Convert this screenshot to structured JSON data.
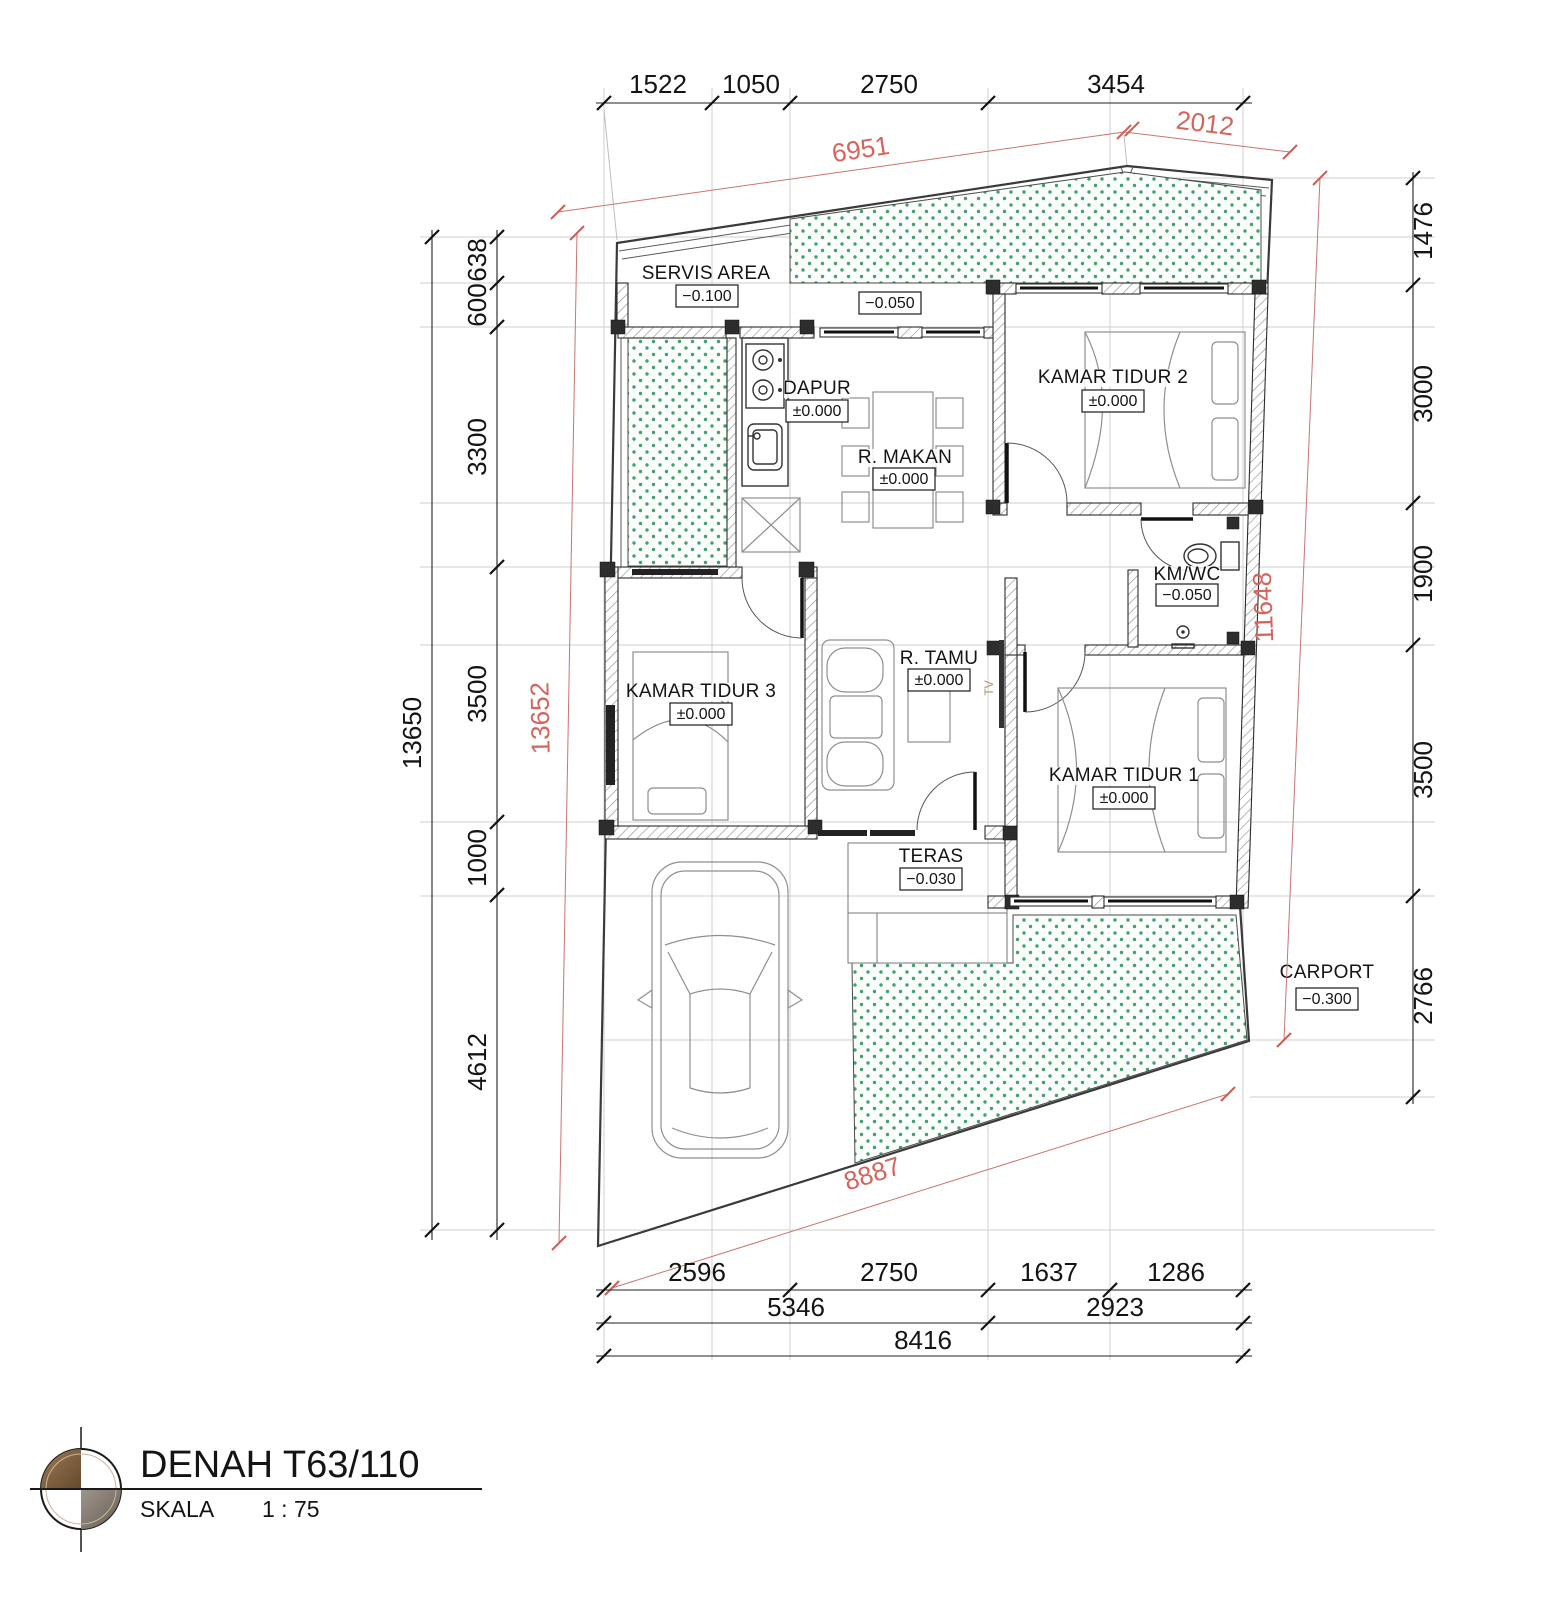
{
  "title": {
    "name": "DENAH T63/110",
    "scale_label": "SKALA",
    "scale_value": "1 : 75"
  },
  "rooms": {
    "servis_area": {
      "name": "SERVIS AREA",
      "level": "−0.100"
    },
    "side_yard": {
      "level": "−0.050"
    },
    "dapur": {
      "name": "DAPUR",
      "level": "±0.000"
    },
    "r_makan": {
      "name": "R. MAKAN",
      "level": "±0.000"
    },
    "kamar_tidur_2": {
      "name": "KAMAR TIDUR 2",
      "level": "±0.000"
    },
    "km_wc": {
      "name": "KM/WC",
      "level": "−0.050"
    },
    "kamar_tidur_3": {
      "name": "KAMAR TIDUR 3",
      "level": "±0.000"
    },
    "r_tamu": {
      "name": "R. TAMU",
      "level": "±0.000"
    },
    "kamar_tidur_1": {
      "name": "KAMAR TIDUR 1",
      "level": "±0.000"
    },
    "teras": {
      "name": "TERAS",
      "level": "−0.030"
    },
    "carport": {
      "name": "CARPORT",
      "level": "−0.300"
    },
    "tv": "TV"
  },
  "dims": {
    "top": [
      "1522",
      "1050",
      "2750",
      "3454"
    ],
    "top_diag_left": "6951",
    "top_diag_right": "2012",
    "left_total": "13650",
    "left": [
      "638",
      "600",
      "3300",
      "3500",
      "1000",
      "4612"
    ],
    "left_diag": "13652",
    "right": [
      "1476",
      "3000",
      "1900",
      "3500",
      "2766"
    ],
    "right_diag": "11648",
    "bottom_row1": [
      "2596",
      "2750",
      "1637",
      "1286"
    ],
    "bottom_row2": [
      "5346",
      "2923"
    ],
    "bottom_row3": "8416",
    "bottom_diag": "8887"
  },
  "colors": {
    "dim_red": "#d4645c",
    "garden_green": "#44a06f",
    "wall_dark": "#2d2d2d",
    "logo_brown": "#8a6644",
    "logo_gray": "#867c70"
  }
}
